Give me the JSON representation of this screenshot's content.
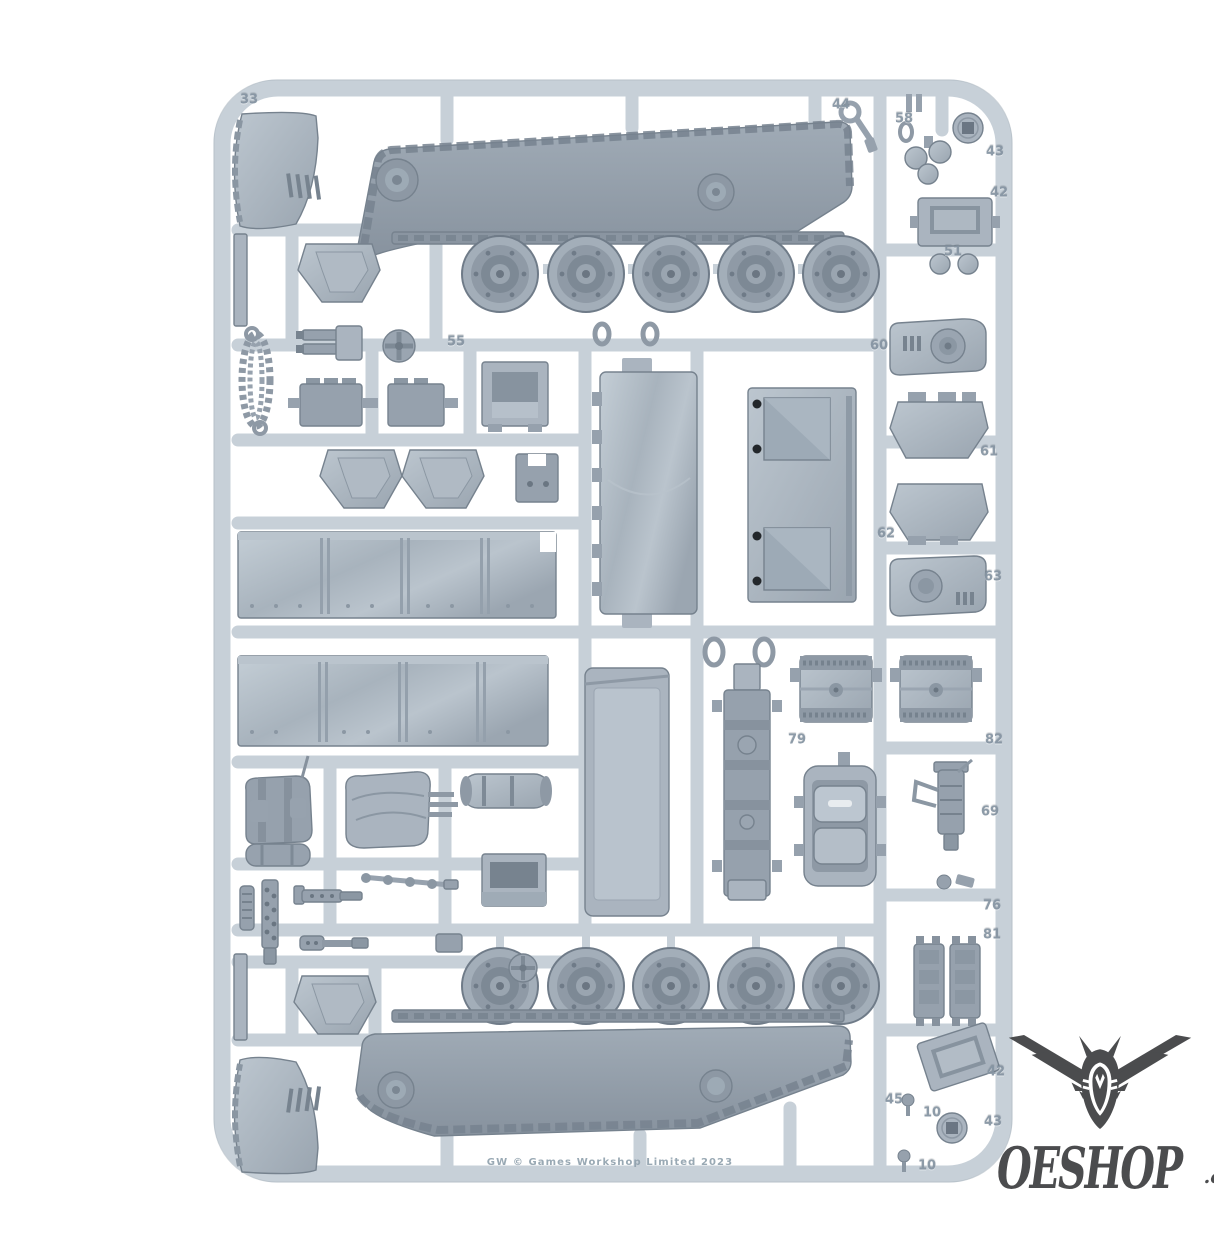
{
  "sprue": {
    "copyright_text": "GW  © Games Workshop Limited 2023",
    "colors": {
      "background": "#ffffff",
      "frame": "#c7d0d8",
      "frame_edge": "#a9b4be",
      "part": "#aab4bf",
      "part_dark": "#96a1ad",
      "recess": "#77838f",
      "body": "#909ba7",
      "label": "#8493a1",
      "copyright": "#8fa0ac"
    },
    "part_numbers": [
      {
        "label": "33",
        "x": 249,
        "y": 100
      },
      {
        "label": "44",
        "x": 841,
        "y": 105
      },
      {
        "label": "58",
        "x": 904,
        "y": 119
      },
      {
        "label": "43",
        "x": 995,
        "y": 152
      },
      {
        "label": "42",
        "x": 999,
        "y": 193
      },
      {
        "label": "51",
        "x": 953,
        "y": 252
      },
      {
        "label": "55",
        "x": 456,
        "y": 342
      },
      {
        "label": "60",
        "x": 879,
        "y": 346
      },
      {
        "label": "61",
        "x": 989,
        "y": 452
      },
      {
        "label": "62",
        "x": 886,
        "y": 534
      },
      {
        "label": "63",
        "x": 993,
        "y": 577
      },
      {
        "label": "79",
        "x": 797,
        "y": 740
      },
      {
        "label": "82",
        "x": 994,
        "y": 740
      },
      {
        "label": "69",
        "x": 990,
        "y": 812
      },
      {
        "label": "76",
        "x": 992,
        "y": 906
      },
      {
        "label": "81",
        "x": 992,
        "y": 935
      },
      {
        "label": "42",
        "x": 996,
        "y": 1072
      },
      {
        "label": "45",
        "x": 894,
        "y": 1100
      },
      {
        "label": "10",
        "x": 932,
        "y": 1113
      },
      {
        "label": "43",
        "x": 993,
        "y": 1122
      },
      {
        "label": "10",
        "x": 927,
        "y": 1166
      }
    ]
  },
  "watermark": {
    "brand": "OESHOP",
    "suffix": ".co.uk",
    "icon": "winged-helmet-icon",
    "color": "#3e3f41"
  }
}
